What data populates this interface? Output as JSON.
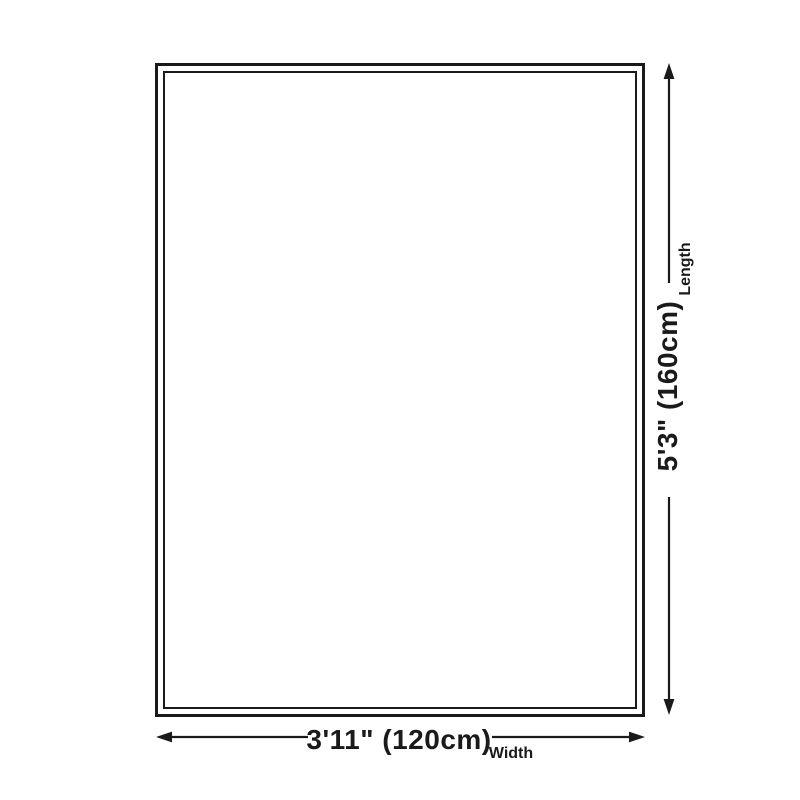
{
  "diagram": {
    "background_color": "#ffffff",
    "line_color": "#1a1a1a",
    "length": {
      "value": "5'3\" (160cm)",
      "label": "Length"
    },
    "width": {
      "value": "3'11\" (120cm)",
      "label": "Width"
    }
  }
}
